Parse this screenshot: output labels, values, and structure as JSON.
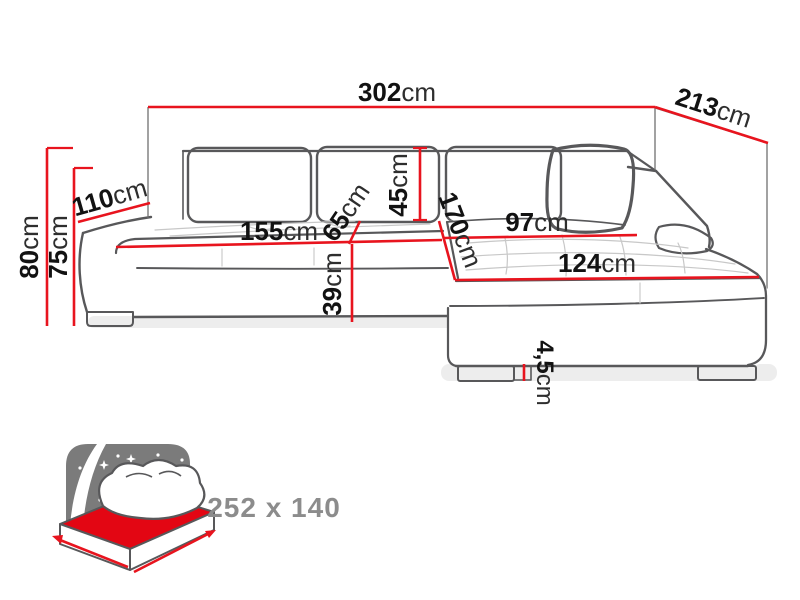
{
  "diagram": {
    "kind": "corner-sofa-dimension-drawing",
    "colors": {
      "dimension_red": "#e8141e",
      "sofa_outline": "#58585a",
      "tufting_gray": "#c8c8c8",
      "icon_panel_gray": "#7b7b7b",
      "icon_text_gray": "#8c8c8c",
      "bed_highlight_red": "#e30613",
      "background": "#ffffff",
      "label_text": "#161616"
    }
  },
  "labels": {
    "width_total": {
      "value": "302",
      "unit": "cm"
    },
    "depth_total": {
      "value": "213",
      "unit": "cm"
    },
    "height_total": {
      "value": "80",
      "unit": "cm"
    },
    "armrest_height": {
      "value": "75",
      "unit": "cm"
    },
    "armrest_length": {
      "value": "110",
      "unit": "cm"
    },
    "seat_width": {
      "value": "155",
      "unit": "cm"
    },
    "seat_depth": {
      "value": "65",
      "unit": "cm"
    },
    "back_cushion_height": {
      "value": "45",
      "unit": "cm"
    },
    "chaise_length": {
      "value": "170",
      "unit": "cm"
    },
    "chaise_seat_width": {
      "value": "97",
      "unit": "cm"
    },
    "chaise_front_width": {
      "value": "124",
      "unit": "cm"
    },
    "seat_height": {
      "value": "39",
      "unit": "cm"
    },
    "leg_height": {
      "value": "4,5",
      "unit": "cm"
    }
  },
  "sleeping_function": {
    "size_label": "252 x 140"
  }
}
